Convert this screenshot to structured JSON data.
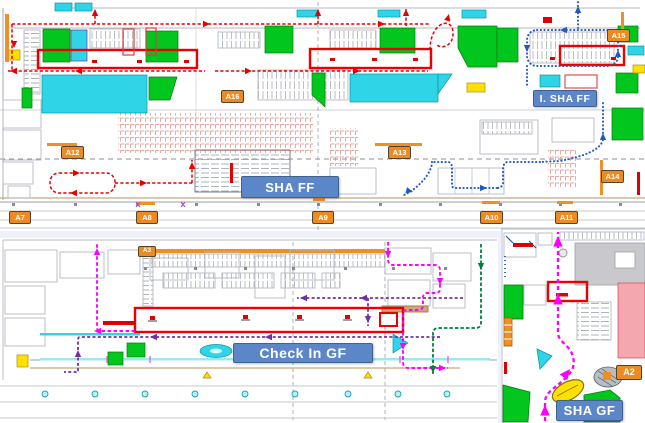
{
  "banners": {
    "sha_ff": "SHA FF",
    "i_sha_ff": "I. SHA FF",
    "check_in_gf": "Check In GF",
    "sha_gf": "SHA GF"
  },
  "gate_labels": {
    "a2": "A2",
    "a3": "A3",
    "a7": "A7",
    "a8": "A8",
    "a9": "A9",
    "a10": "A10",
    "a11": "A11",
    "a12": "A12",
    "a13": "A13",
    "a14": "A14",
    "a15": "A15",
    "a16": "A16"
  },
  "colors": {
    "zone_green": "#00c61e",
    "zone_cyan": "#2fd4e6",
    "zone_yellow": "#ffe100",
    "zone_gray": "#c9c9cd",
    "zone_pink": "#f4a7ae",
    "gate_label_orange": "#ed8b22",
    "route_red": "#e60000",
    "route_blue": "#2457c5",
    "route_purple": "#7030a0",
    "route_magenta": "#ff00ff",
    "route_dark_green": "#00813c",
    "banner_blue": "#5b87c9",
    "highlight_box_red": "#ee0000"
  }
}
